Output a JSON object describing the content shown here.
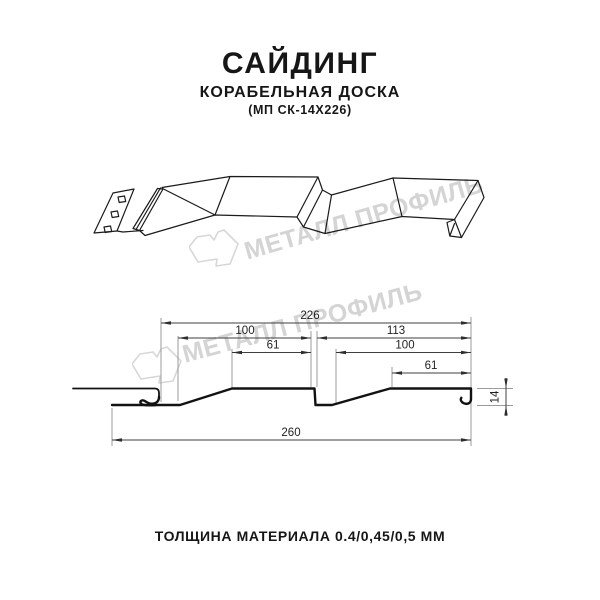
{
  "header": {
    "title": "САЙДИНГ",
    "subtitle": "КОРАБЕЛЬНАЯ ДОСКА",
    "code": "(МП СК-14Х226)"
  },
  "watermark": {
    "text": "МЕТАЛЛ ПРОФИЛЬ",
    "color": "#d4d4d4",
    "logo": "metal-profil-emblem"
  },
  "drawing_3d": {
    "description": "perspective line drawing of ship-lap siding panel with nail strip"
  },
  "cross_section": {
    "dims": {
      "total_top": "226",
      "left_100": "100",
      "right_113": "113",
      "left_61": "61",
      "right_100": "100",
      "right_61": "61",
      "bottom_260": "260",
      "height_14": "14"
    }
  },
  "footer": {
    "text": "ТОЛЩИНА МАТЕРИАЛА 0.4/0,45/0,5 ММ"
  }
}
